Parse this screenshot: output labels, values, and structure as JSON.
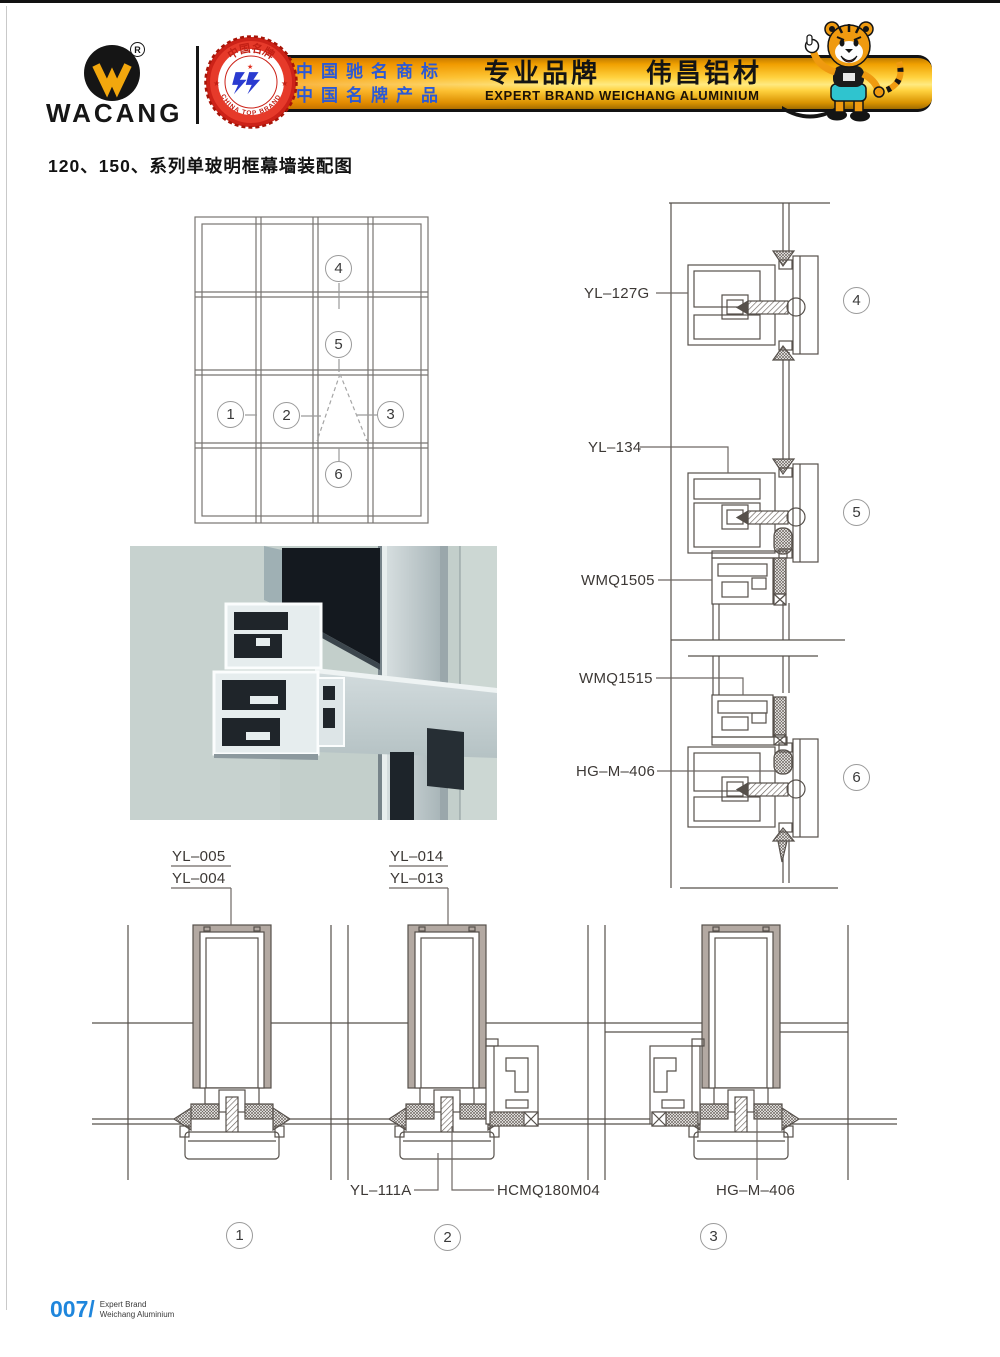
{
  "header": {
    "brand": "WACANG",
    "reg_mark": "R",
    "badge": {
      "arc_top": "中国名牌",
      "arc_bottom": "CHINA TOP BRAND"
    },
    "banner": {
      "cn_line1": "中国驰名商标",
      "cn_line2": "中国名牌产品",
      "slogan_cn": "专业品牌",
      "brand_cn": "伟昌铝材",
      "slogan_en": "EXPERT BRAND WEICHANG ALUMINIUM"
    }
  },
  "page_title": "120、150、系列单玻明框幕墙装配图",
  "elevation_markers": {
    "m1": "1",
    "m2": "2",
    "m3": "3",
    "m4": "4",
    "m5": "5",
    "m6": "6"
  },
  "right_details": {
    "labels": {
      "yl127g": "YL–127G",
      "yl134": "YL–134",
      "wmq1505": "WMQ1505",
      "wmq1515": "WMQ1515",
      "hgm406": "HG–M–406"
    },
    "markers": {
      "d4": "4",
      "d5": "5",
      "d6": "6"
    }
  },
  "bottom_details": {
    "labels": {
      "yl005": "YL–005",
      "yl004": "YL–004",
      "yl014": "YL–014",
      "yl013": "YL–013",
      "yl111a": "YL–111A",
      "hcmq180m04": "HCMQ180M04",
      "hgm406": "HG–M–406"
    },
    "markers": {
      "d1": "1",
      "d2": "2",
      "d3": "3"
    }
  },
  "footer": {
    "page_number": "007/",
    "caption_line1": "Expert Brand",
    "caption_line2": "Weichang Aluminium"
  },
  "colors": {
    "banner_gold": "#ffd23f",
    "badge_red": "#cc2218",
    "logo_yellow": "#f2a70d",
    "cn_text_blue": "#2b59d6",
    "footer_blue": "#1f86dc",
    "drawing_line": "#56504b",
    "mullion_fill": "#b3a9a2"
  }
}
